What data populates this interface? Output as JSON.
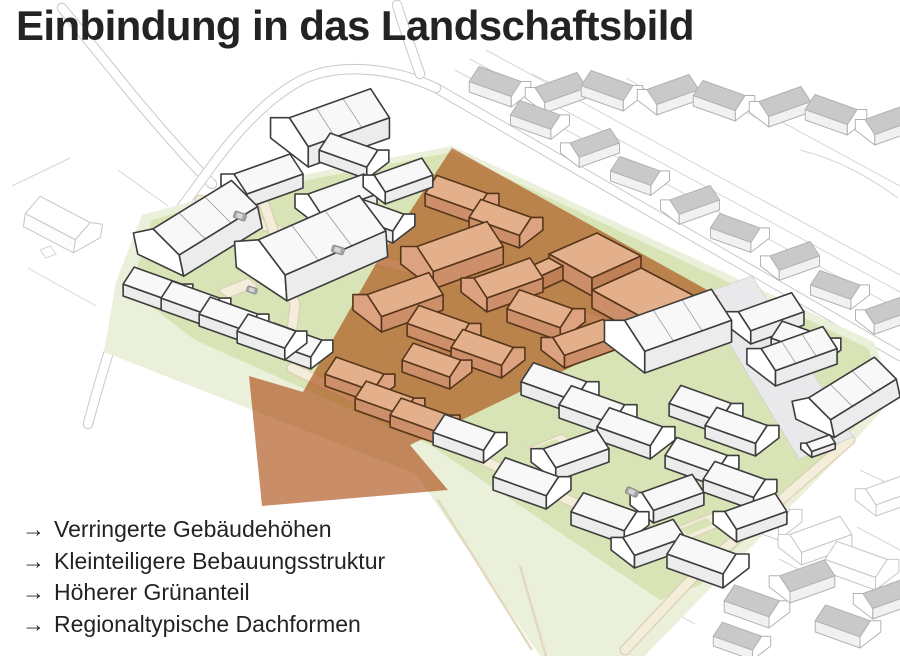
{
  "title": "Einbindung in das Landschaftsbild",
  "bullets": {
    "arrow": "→",
    "items": [
      {
        "text": "Verringerte Gebäudehöhen"
      },
      {
        "text": "Kleinteiligere Bebauungsstruktur"
      },
      {
        "text": "Höherer Grünanteil"
      },
      {
        "text": "Regionaltypische Dachformen"
      }
    ]
  },
  "colors": {
    "text": "#232323",
    "overlay": "#a8470b",
    "lawn": "#d8e4b5",
    "field": "#eaf0da",
    "path": "#f3edda",
    "pathEdge": "#d9cfb5",
    "plaza": "#e9e9eb",
    "terraGable": "#dda27f",
    "terraWall": "#cd8f6a",
    "terraRoof": "#e4b08b",
    "ctxRoof": "#c9c9c9"
  }
}
